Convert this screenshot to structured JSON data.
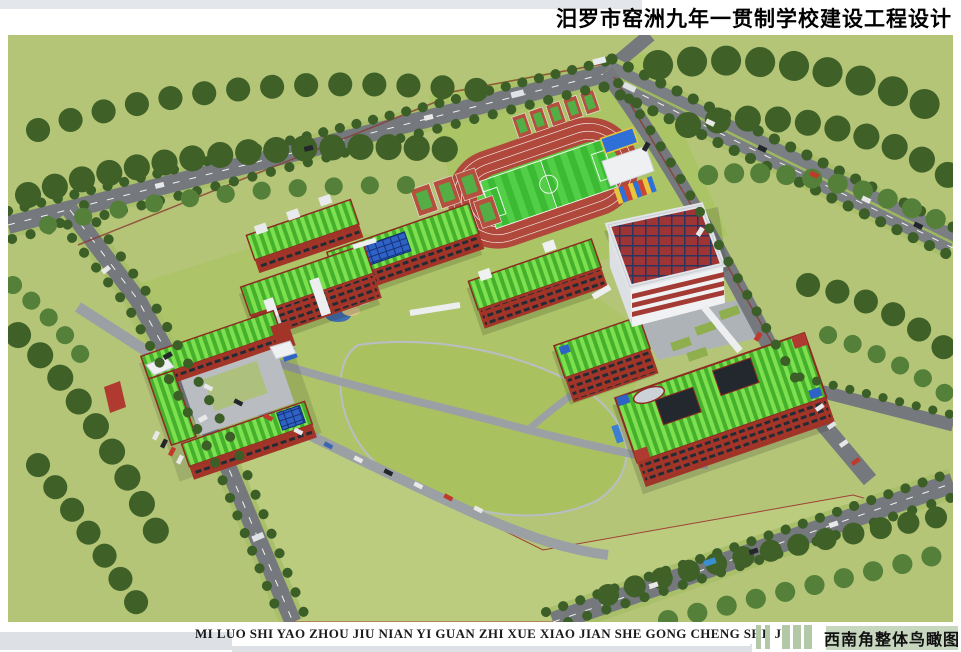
{
  "header": {
    "title": "汨罗市窑洲九年一贯制学校建设工程设计"
  },
  "footer": {
    "pinyin": "MI LUO SHI YAO ZHOU JIU NIAN YI GUAN ZHI XUE XIAO JIAN SHE GONG CHENG SHE JI",
    "caption": "西南角整体鸟瞰图"
  },
  "rendering": {
    "type": "aerial architectural rendering",
    "view": "southwest overall bird's-eye view of school campus",
    "features": [
      "running track with soccer field",
      "basketball courts",
      "grandstand with canopy",
      "white gymnasium with red skylight-grid roof",
      "red brick teaching and dormitory buildings with green striped roofs",
      "rooftop solar panels",
      "central lawn and pond",
      "parking rows with cars",
      "perimeter roads with street trees and buses",
      "forest belts",
      "large reserved green field"
    ]
  },
  "palette": {
    "grass": "#b4c578",
    "trees": "#3f6128",
    "road": "#75797e",
    "track_red": "#b0493c",
    "pitch_green": "#3cba34",
    "roof_green": "#45b02c",
    "brick_red": "#a23528",
    "pv_blue": "#2e62c4",
    "gym_roof_red": "#a23737",
    "gym_wall": "#f0f1f3",
    "badge_sage": "#c6d6bf",
    "bar_gray": "#dde1e6"
  }
}
